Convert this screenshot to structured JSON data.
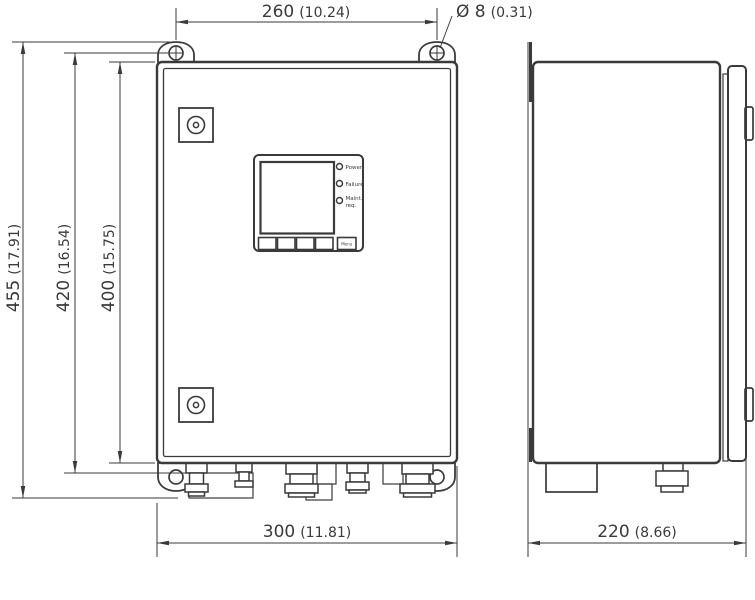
{
  "drawing": {
    "type": "technical-dimension-drawing",
    "views": {
      "front": "front view",
      "side": "side view"
    },
    "colors": {
      "line": "#3a3a3c",
      "background": "#ffffff"
    }
  },
  "dimensions": {
    "mount_hole_spacing": {
      "mm": "260",
      "inch": "(10.24)"
    },
    "mount_hole_diameter": {
      "mm": "Ø 8",
      "inch": "(0.31)"
    },
    "overall_height": {
      "mm": "455",
      "inch": "(17.91)"
    },
    "mount_height": {
      "mm": "420",
      "inch": "(16.54)"
    },
    "body_height": {
      "mm": "400",
      "inch": "(15.75)"
    },
    "body_width": {
      "mm": "300",
      "inch": "(11.81)"
    },
    "body_depth": {
      "mm": "220",
      "inch": "(8.66)"
    }
  },
  "panel": {
    "led_power": "Power",
    "led_failure": "Failure",
    "led_maint_line1": "Maint.",
    "led_maint_line2": "req.",
    "menu_button": "Menu"
  }
}
